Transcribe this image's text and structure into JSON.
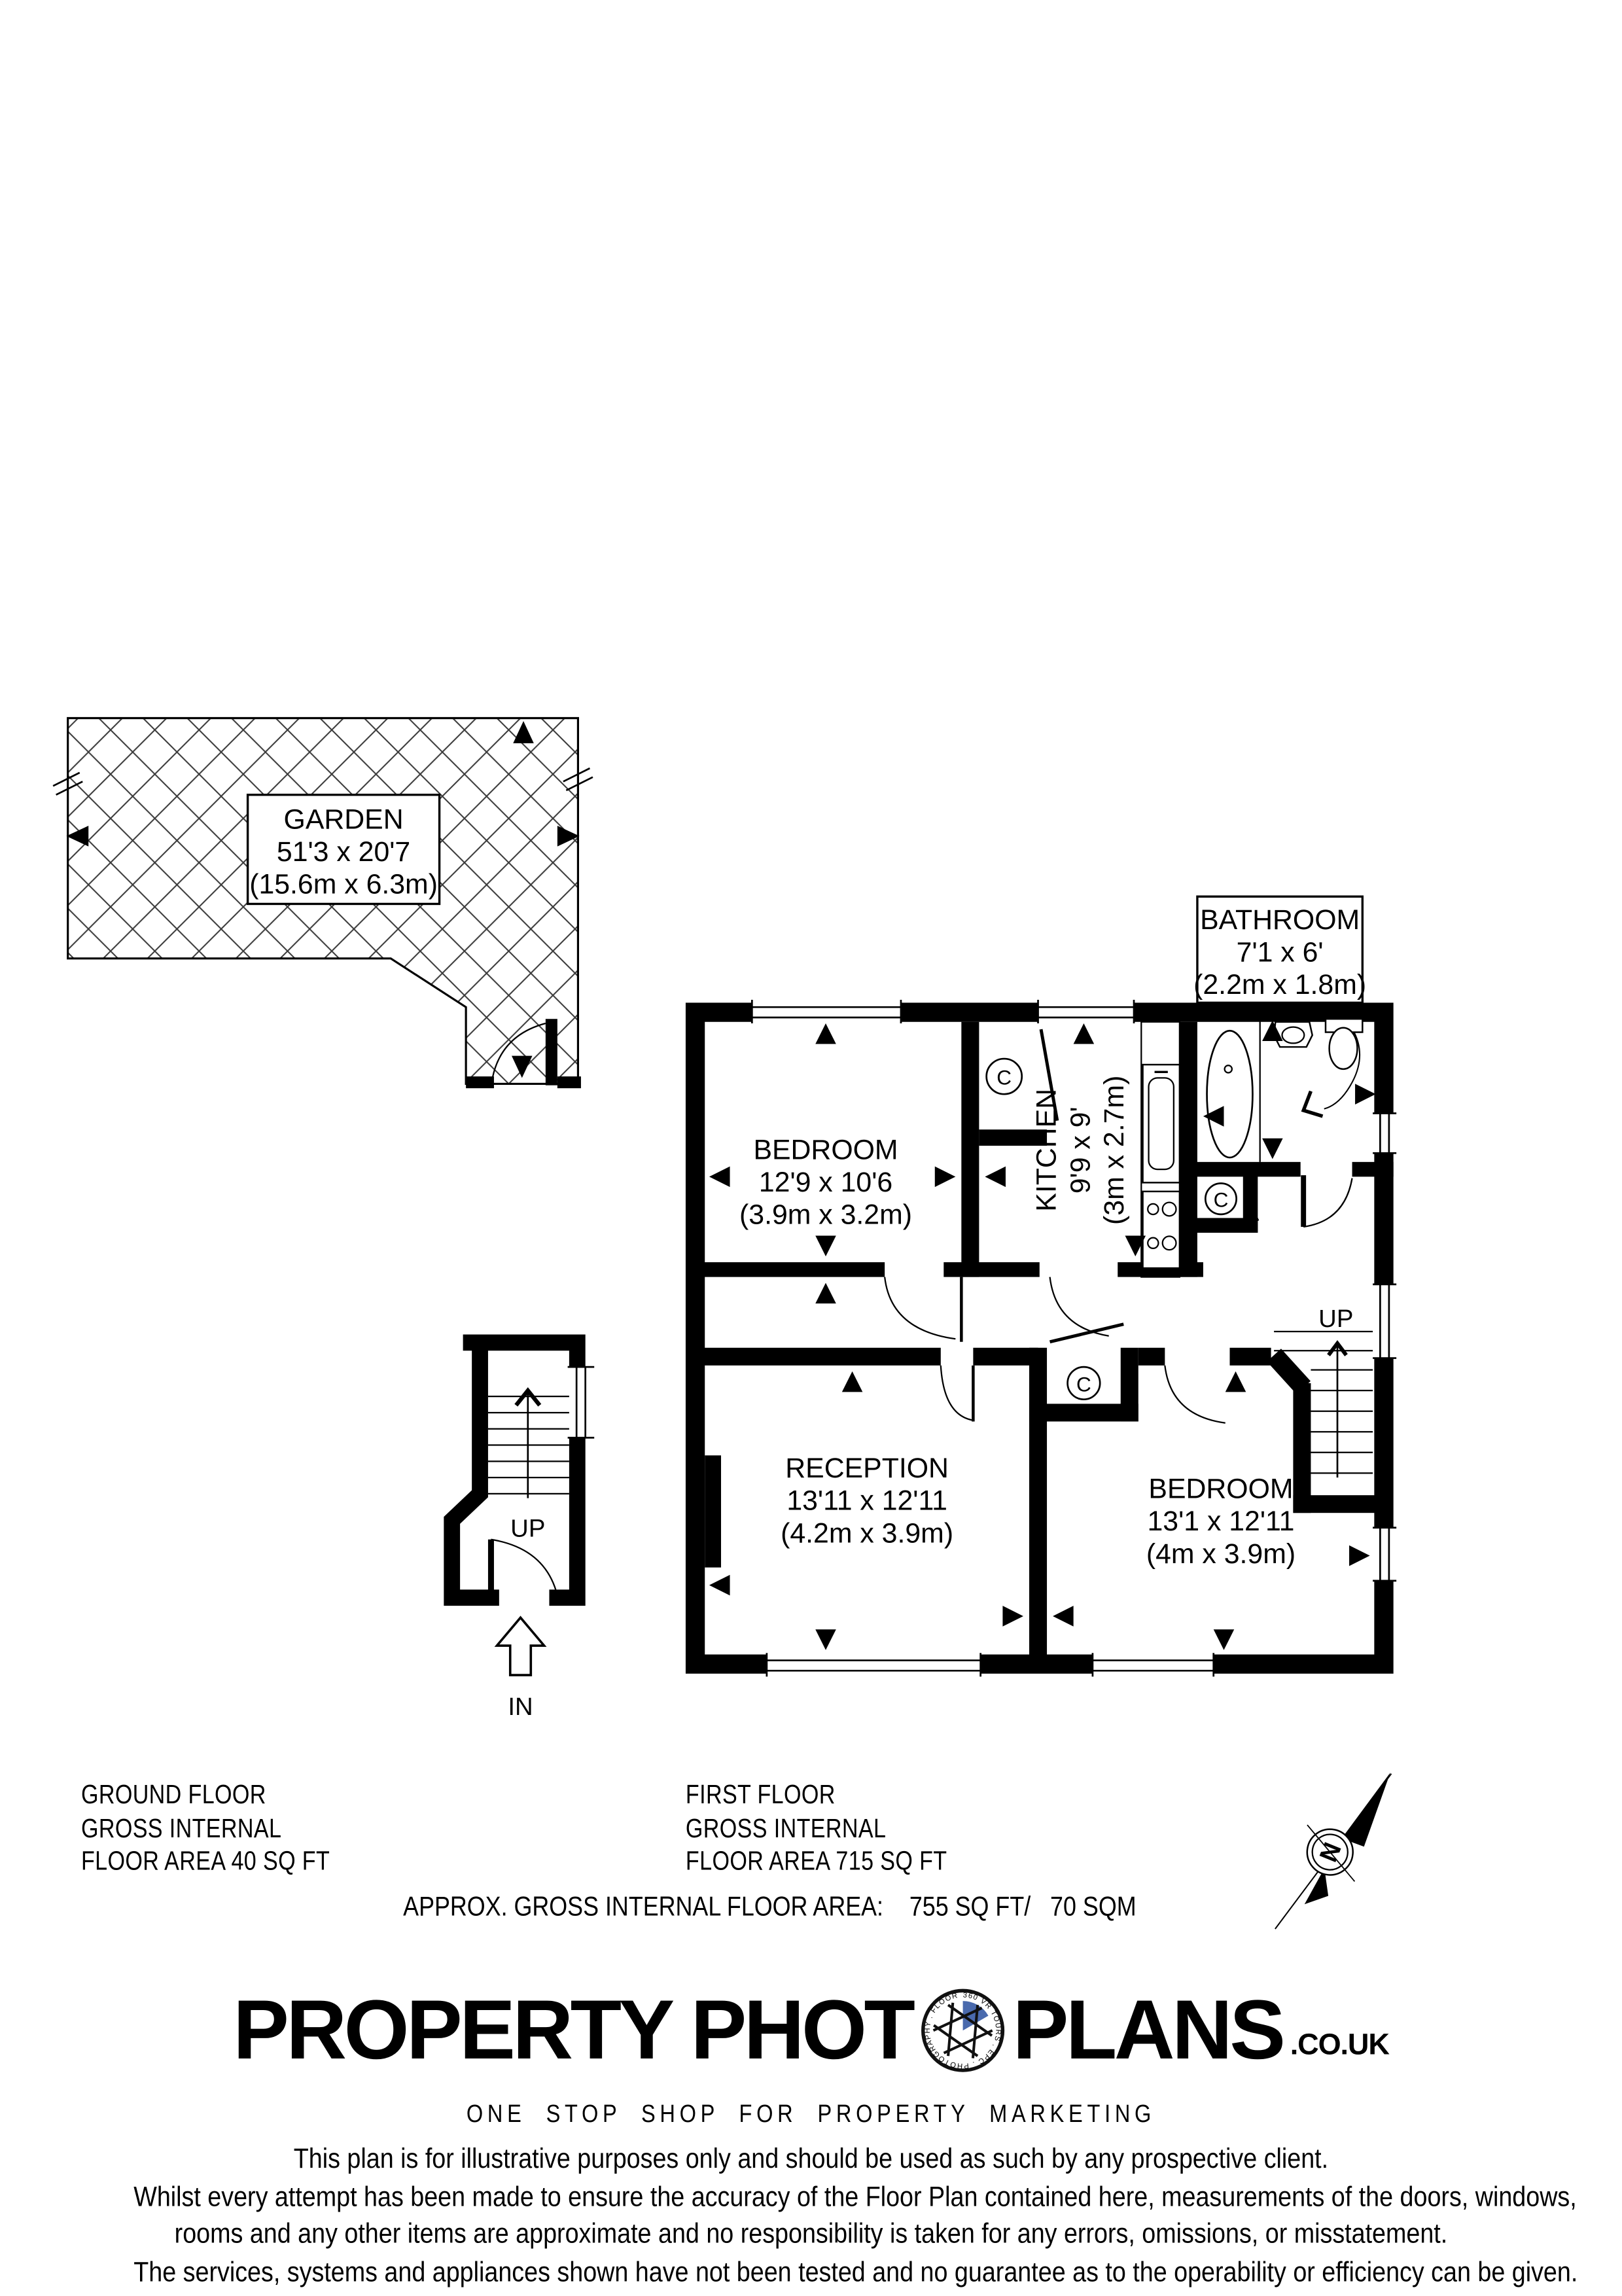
{
  "plan": {
    "garden": {
      "name": "GARDEN",
      "dims_ft": "51'3 x 20'7",
      "dims_m": "(15.6m x 6.3m)"
    },
    "bathroom": {
      "name": "BATHROOM",
      "dims_ft": "7'1 x 6'",
      "dims_m": "(2.2m x 1.8m)"
    },
    "bedroom1": {
      "name": "BEDROOM",
      "dims_ft": "12'9 x 10'6",
      "dims_m": "(3.9m x 3.2m)"
    },
    "kitchen": {
      "name": "KITCHEN",
      "dims_ft": "9'9 x 9'",
      "dims_m": "(3m x 2.7m)"
    },
    "reception": {
      "name": "RECEPTION",
      "dims_ft": "13'11 x 12'11",
      "dims_m": "(4.2m x 3.9m)"
    },
    "bedroom2": {
      "name": "BEDROOM",
      "dims_ft": "13'1 x 12'11",
      "dims_m": "(4m x 3.9m)"
    },
    "up_label": "UP",
    "in_label": "IN",
    "cupboard_symbol": "C",
    "compass_north": "N"
  },
  "summaries": {
    "ground_floor": {
      "line1": "GROUND FLOOR",
      "line2": "GROSS INTERNAL",
      "line3": "FLOOR AREA 40 SQ FT"
    },
    "first_floor": {
      "line1": "FIRST FLOOR",
      "line2": "GROSS INTERNAL",
      "line3": "FLOOR AREA 715 SQ FT"
    },
    "total": "APPROX. GROSS INTERNAL FLOOR AREA:    755 SQ FT/   70 SQM"
  },
  "logo": {
    "part1": "PROPERTY PHOT",
    "part2": "PLANS",
    "suffix": ".CO.UK",
    "tagline": "ONE STOP SHOP FOR PROPERTY MARKETING",
    "ring_text": "360 VR TOURS . EPC . PHOTOGRAPHY . FLOOR PLANS .",
    "aperture_blue": "#4a6aad"
  },
  "disclaimer": {
    "line1": "This plan is for illustrative purposes only and should be used as such by any prospective client.",
    "line2": "Whilst every attempt has been made to ensure the accuracy of the Floor Plan contained here, measurements of the doors, windows,",
    "line3": "rooms and any other items are approximate and no responsibility is taken for any errors, omissions, or misstatement.",
    "line4": "The services, systems and appliances shown have not been tested and no guarantee as to the operability or efficiency can be given."
  }
}
